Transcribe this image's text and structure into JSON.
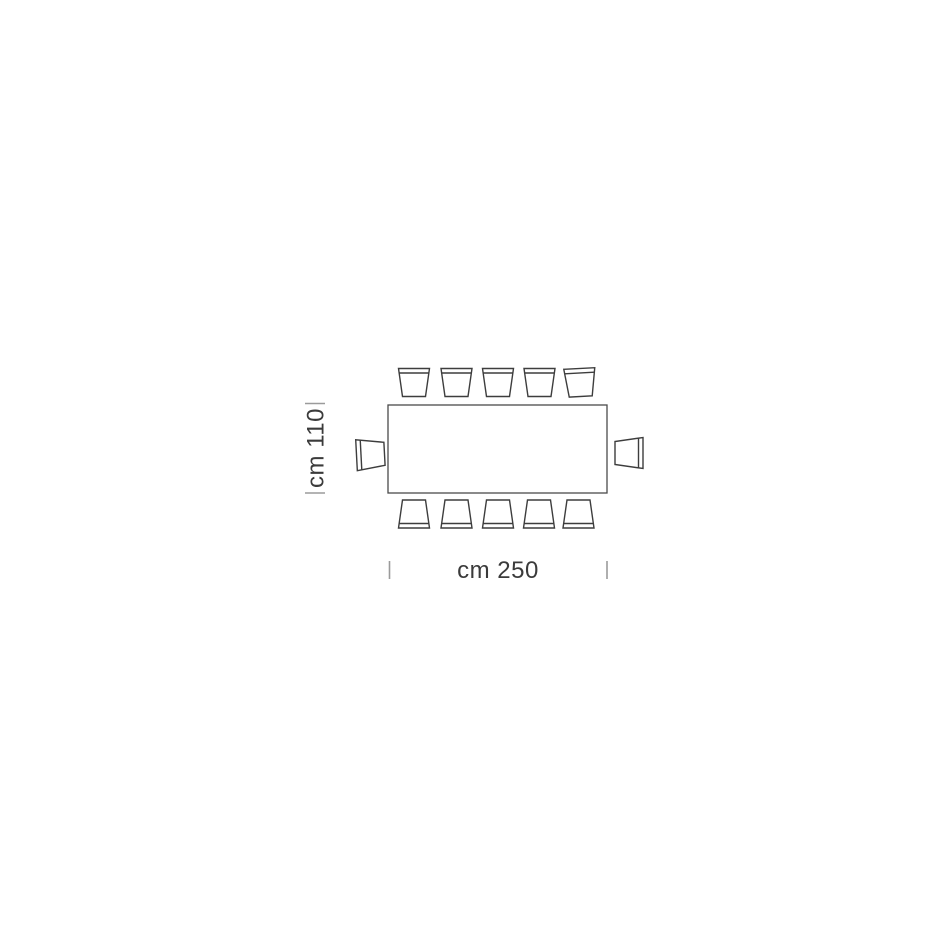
{
  "diagram": {
    "kind": "table-seating-plan-top-view",
    "table": {
      "shape": "rectangle",
      "width_cm": 250,
      "depth_cm": 110,
      "width_label": "cm 250",
      "depth_label": "cm 110"
    },
    "seating": {
      "top_chairs": 5,
      "bottom_chairs": 5,
      "left_chairs": 1,
      "right_chairs": 1,
      "total_seats": 12
    },
    "colors": {
      "background": "#ffffff",
      "table_outline": "#4a4a4a",
      "chair_outline": "#3d3d3d",
      "tick": "#9b9b9b",
      "label_text": "#3b3b3b"
    }
  }
}
